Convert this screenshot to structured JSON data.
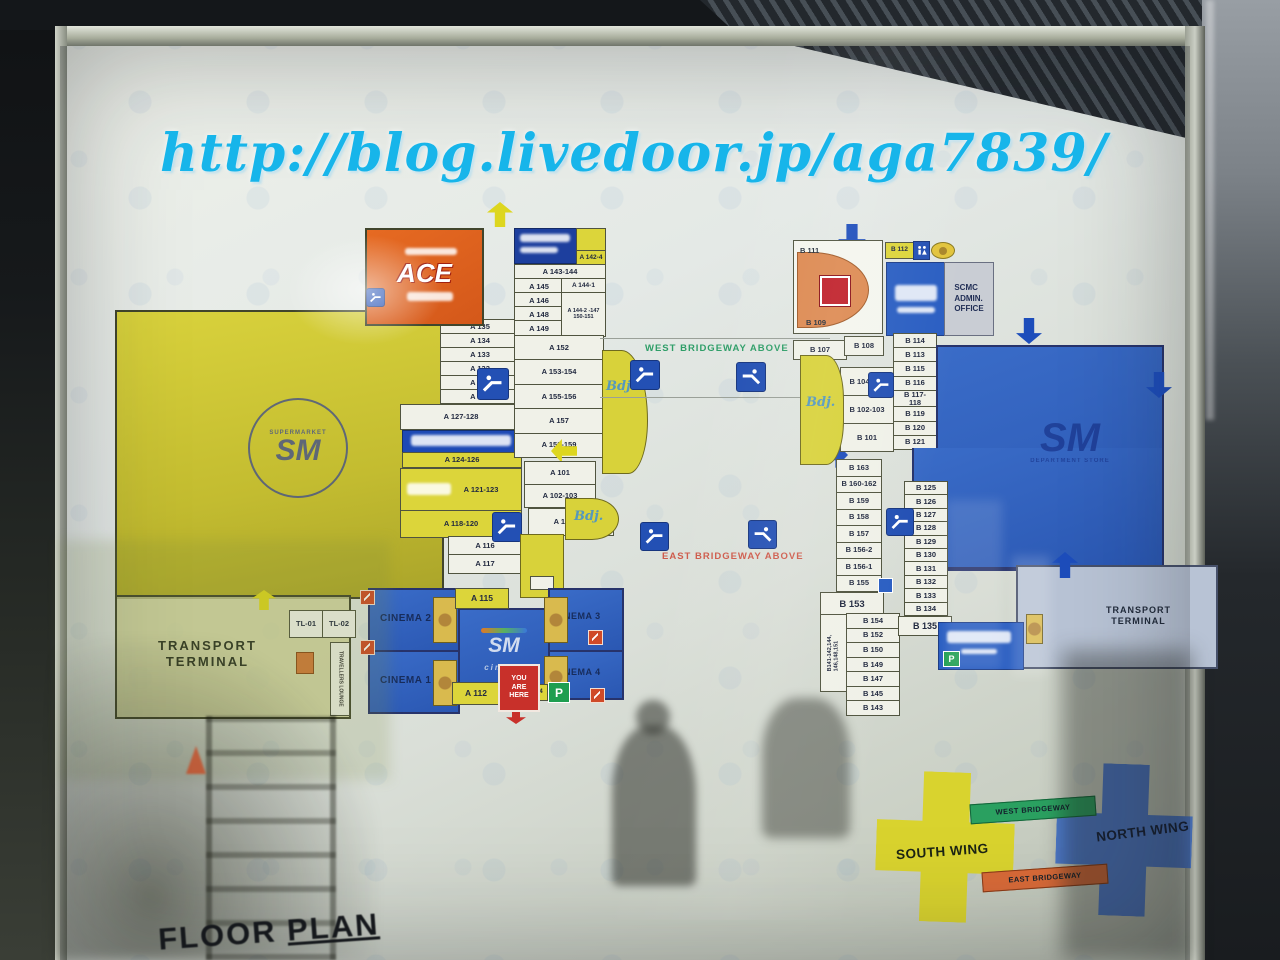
{
  "watermark": "http://blog.livedoor.jp/aga7839/",
  "floor_plan_title_1": "FLOOR",
  "floor_plan_title_2": "PLAN",
  "corridor": {
    "west_label": "WEST BRIDGEWAY ABOVE",
    "east_label": "EAST BRIDGEWAY ABOVE"
  },
  "legend": {
    "south_wing": "SOUTH WING",
    "north_wing": "NORTH WING",
    "west_bridgeway": "WEST BRIDGEWAY",
    "east_bridgeway": "EAST BRIDGEWAY",
    "south_color": "#d9d32e",
    "north_color": "#4f7dd2",
    "west_color": "#2aa060",
    "east_color": "#d86a38"
  },
  "south_wing": {
    "supermarket_sm": "SM",
    "supermarket_ring": "SUPERMARKET",
    "ace_logo": "ACE",
    "left_strip": [
      "A 135",
      "A 134",
      "A 133",
      "A 132",
      "A 131",
      "A 130"
    ],
    "a127": "A 127-128",
    "a124": "A 124-126",
    "a121": "A 121-123",
    "a118": "A 118-120",
    "a116": "A 116",
    "a117": "A 117",
    "a142": "A 142-4",
    "a143": "A 143-144",
    "grid": {
      "a145": "A 145",
      "a144_1": "A 144-1",
      "a146": "A 146",
      "a148": "A 148",
      "a149": "A 149",
      "a144_2": "A 144-2 -147\n150-151"
    },
    "mid_strip": [
      "A 152",
      "A 153-154",
      "A 155-156",
      "A 157",
      "A 158-159"
    ],
    "low_strip": [
      "A 101",
      "A 102-103"
    ],
    "a104": "A 104-106",
    "script_logo": "Bdj.",
    "cinema": {
      "c1": "CINEMA 1",
      "c2": "CINEMA 2",
      "c3": "CINEMA 3",
      "c4": "CINEMA 4",
      "logo_sm": "SM",
      "logo_sub": "cinema",
      "a115": "A 115",
      "a112": "A 112",
      "a114": "A 114",
      "you_are_here": "YOU\nARE\nHERE",
      "parking": "P"
    },
    "transport_terminal": "TRANSPORT\nTERMINAL",
    "tl_rooms": [
      "TL-01",
      "TL-02"
    ],
    "travellers_lounge": "TRAVELLERS LOUNGE"
  },
  "north_wing": {
    "b111": "B 111",
    "b109": "B 109",
    "b107": "B 107",
    "b108": "B 108",
    "b112": "B 112",
    "scmc_office": "SCMC\nADMIN.\nOFFICE",
    "dept_logo": "SM",
    "dept_sub": "DEPARTMENT STORE",
    "col_upper_right": [
      "B 114",
      "B 113",
      "B 115",
      "B 116",
      "B 117-\n118",
      "B 119",
      "B 120",
      "B 121"
    ],
    "col_upper_left": [
      "B 104-106",
      "B 102-103",
      "B 101"
    ],
    "col_lower_left": [
      "B 163",
      "B 160-162",
      "B 159",
      "B 158",
      "B 157",
      "B 156-2",
      "B 156-1",
      "B 155"
    ],
    "b153": "B 153",
    "b141_vertical": "B141-142,144,\n146,148,151",
    "col_lower_mid": [
      "B 154",
      "B 152",
      "B 150",
      "B 149",
      "B 147",
      "B 145",
      "B 143"
    ],
    "col_lower_right": [
      "B 125",
      "B 126",
      "B 127",
      "B 128",
      "B 129",
      "B 130",
      "B 131",
      "B 132",
      "B 133",
      "B 134"
    ],
    "b135": "B 135",
    "parking": "P",
    "transport_terminal": "TRANSPORT\nTERMINAL"
  }
}
